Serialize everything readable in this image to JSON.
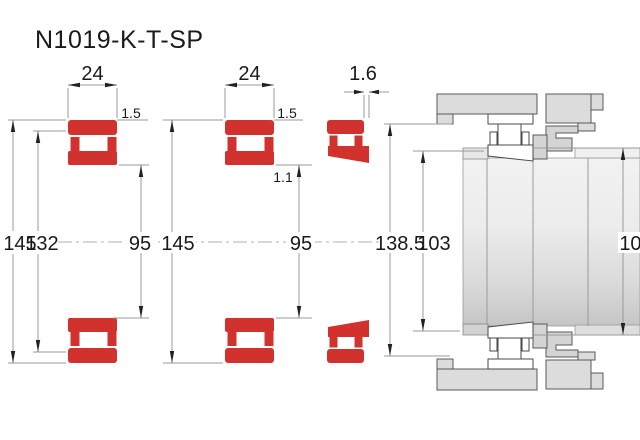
{
  "title": "N1019-K-T-SP",
  "colors": {
    "bearing-red": "#d2322e",
    "dim-line": "#999999",
    "center-line": "#b0b0b0",
    "arrow": "#222222",
    "text": "#1a1a1a",
    "housing-gray": "#dcdcdc",
    "spacer-gray": "#d4d4d4",
    "outline-gray": "#5a5a5a"
  },
  "dims": {
    "fig1": {
      "width": "24",
      "outer_diameter": "145",
      "raceway_diameter": "132",
      "bore_diameter": "95",
      "chamfer_outer": "1.5"
    },
    "fig2": {
      "width": "24",
      "outer_diameter": "145",
      "bore_diameter": "95",
      "chamfer_outer": "1.5",
      "chamfer_inner": "1.1"
    },
    "fig3": {
      "drive_up": "1.6",
      "housing_abutment_diameter": "138.5",
      "shaft_abutment_diameter": "103",
      "right_abutment_diameter": "105"
    }
  }
}
